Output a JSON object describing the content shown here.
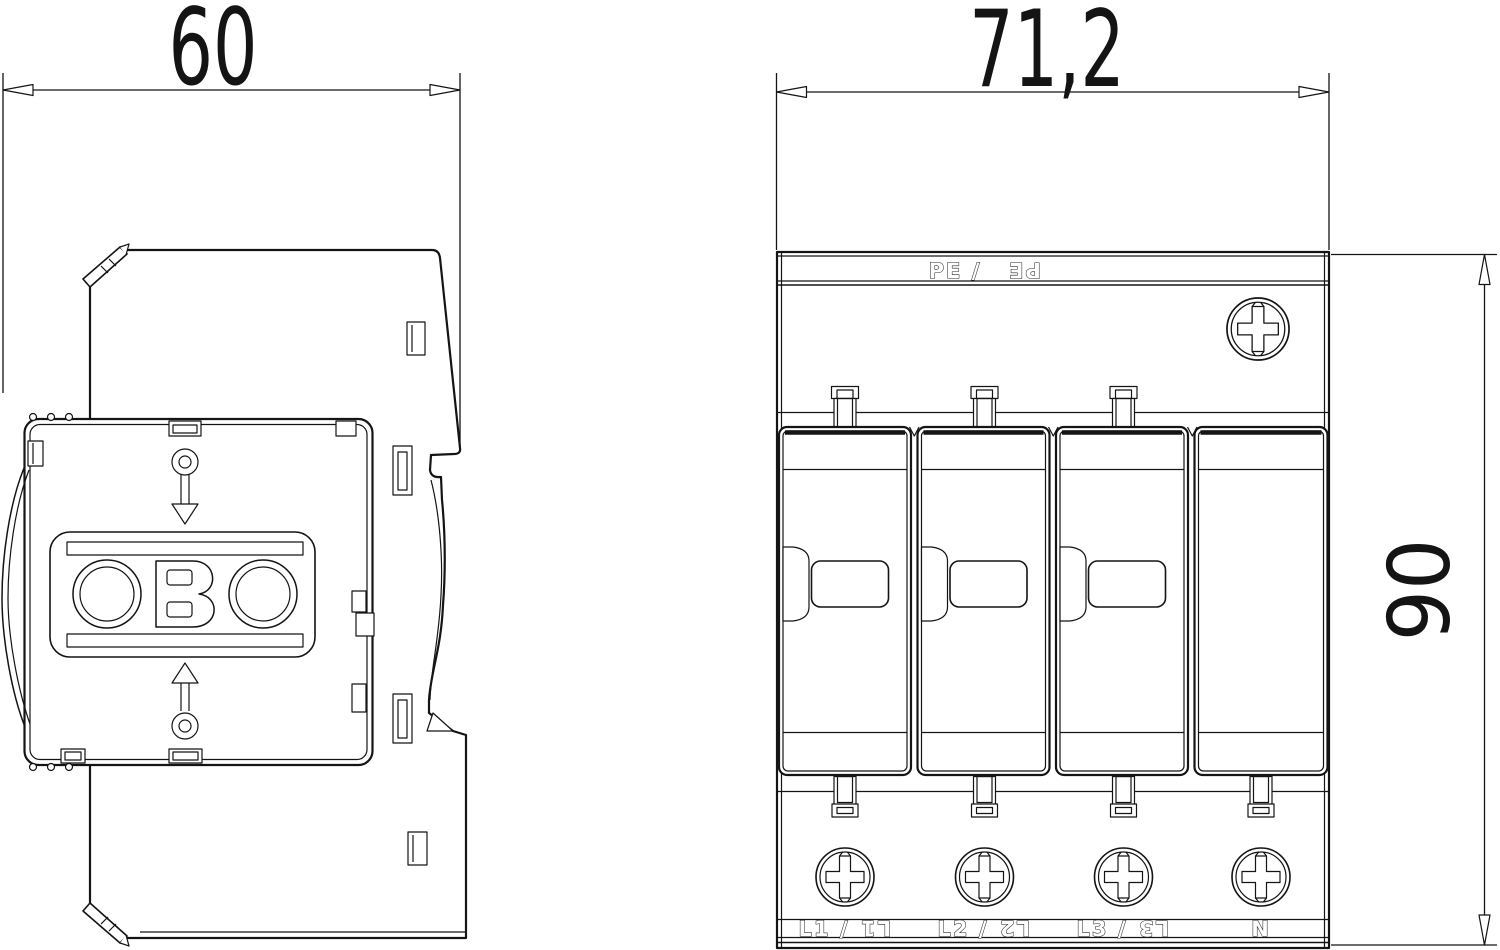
{
  "meta": {
    "drawing_type": "technical dimension drawing",
    "background_color": "#ffffff",
    "line_color": "#141414"
  },
  "dimensions": {
    "side_width": "60",
    "front_width": "71,2",
    "height": "90"
  },
  "side_view": {
    "description": "side profile with DIN-rail clip",
    "logo": "OBO"
  },
  "front_view": {
    "top_band": {
      "normal": "PE /",
      "mirrored": "PE"
    },
    "terminal_labels": [
      {
        "normal": "L1 /",
        "mirrored": "L1"
      },
      {
        "normal": "L2 /",
        "mirrored": "L2"
      },
      {
        "normal": "L3 /",
        "mirrored": "L3"
      },
      {
        "normal": "N",
        "mirrored": ""
      }
    ]
  }
}
